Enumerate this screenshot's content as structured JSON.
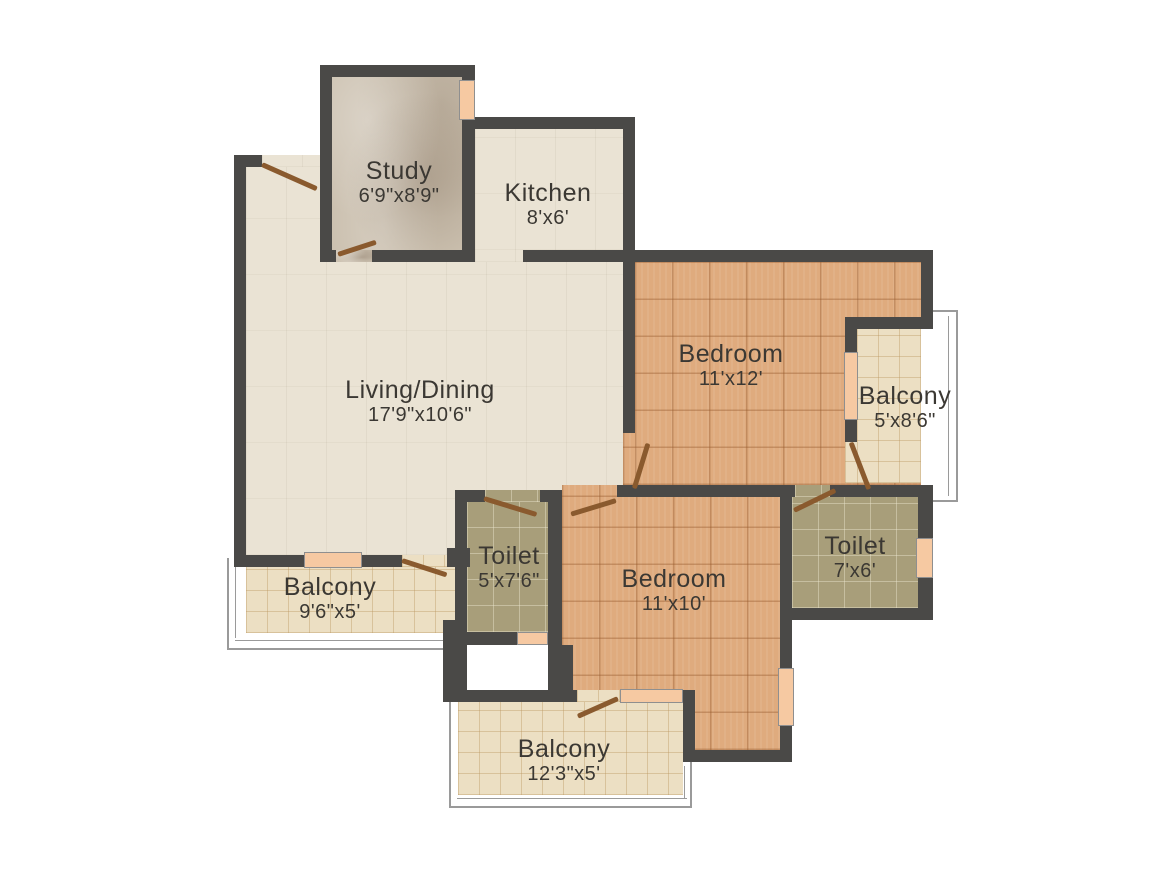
{
  "rooms": {
    "study": {
      "name": "Study",
      "dims": "6'9\"x8'9\""
    },
    "kitchen": {
      "name": "Kitchen",
      "dims": "8'x6'"
    },
    "living": {
      "name": "Living/Dining",
      "dims": "17'9\"x10'6\""
    },
    "bedroom1": {
      "name": "Bedroom",
      "dims": "11'x12'"
    },
    "balcony1": {
      "name": "Balcony",
      "dims": "5'x8'6\""
    },
    "toilet1": {
      "name": "Toilet",
      "dims": "5'x7'6\""
    },
    "bedroom2": {
      "name": "Bedroom",
      "dims": "11'x10'"
    },
    "toilet2": {
      "name": "Toilet",
      "dims": "7'x6'"
    },
    "balcony2": {
      "name": "Balcony",
      "dims": "9'6\"x5'"
    },
    "balcony3": {
      "name": "Balcony",
      "dims": "12'3\"x5'"
    }
  },
  "colors": {
    "wall": "#4a4947",
    "door": "#8a5a2e",
    "window_sill": "#f6c9a2",
    "living_floor": "#eae3d4",
    "study_floor": "#cbc0af",
    "bedroom_floor": "#dfab7e",
    "toilet_floor": "#a89e7a",
    "balcony_floor": "#ecdfc3",
    "railing": "#9a9a9a",
    "label_text": "#3b3833"
  }
}
